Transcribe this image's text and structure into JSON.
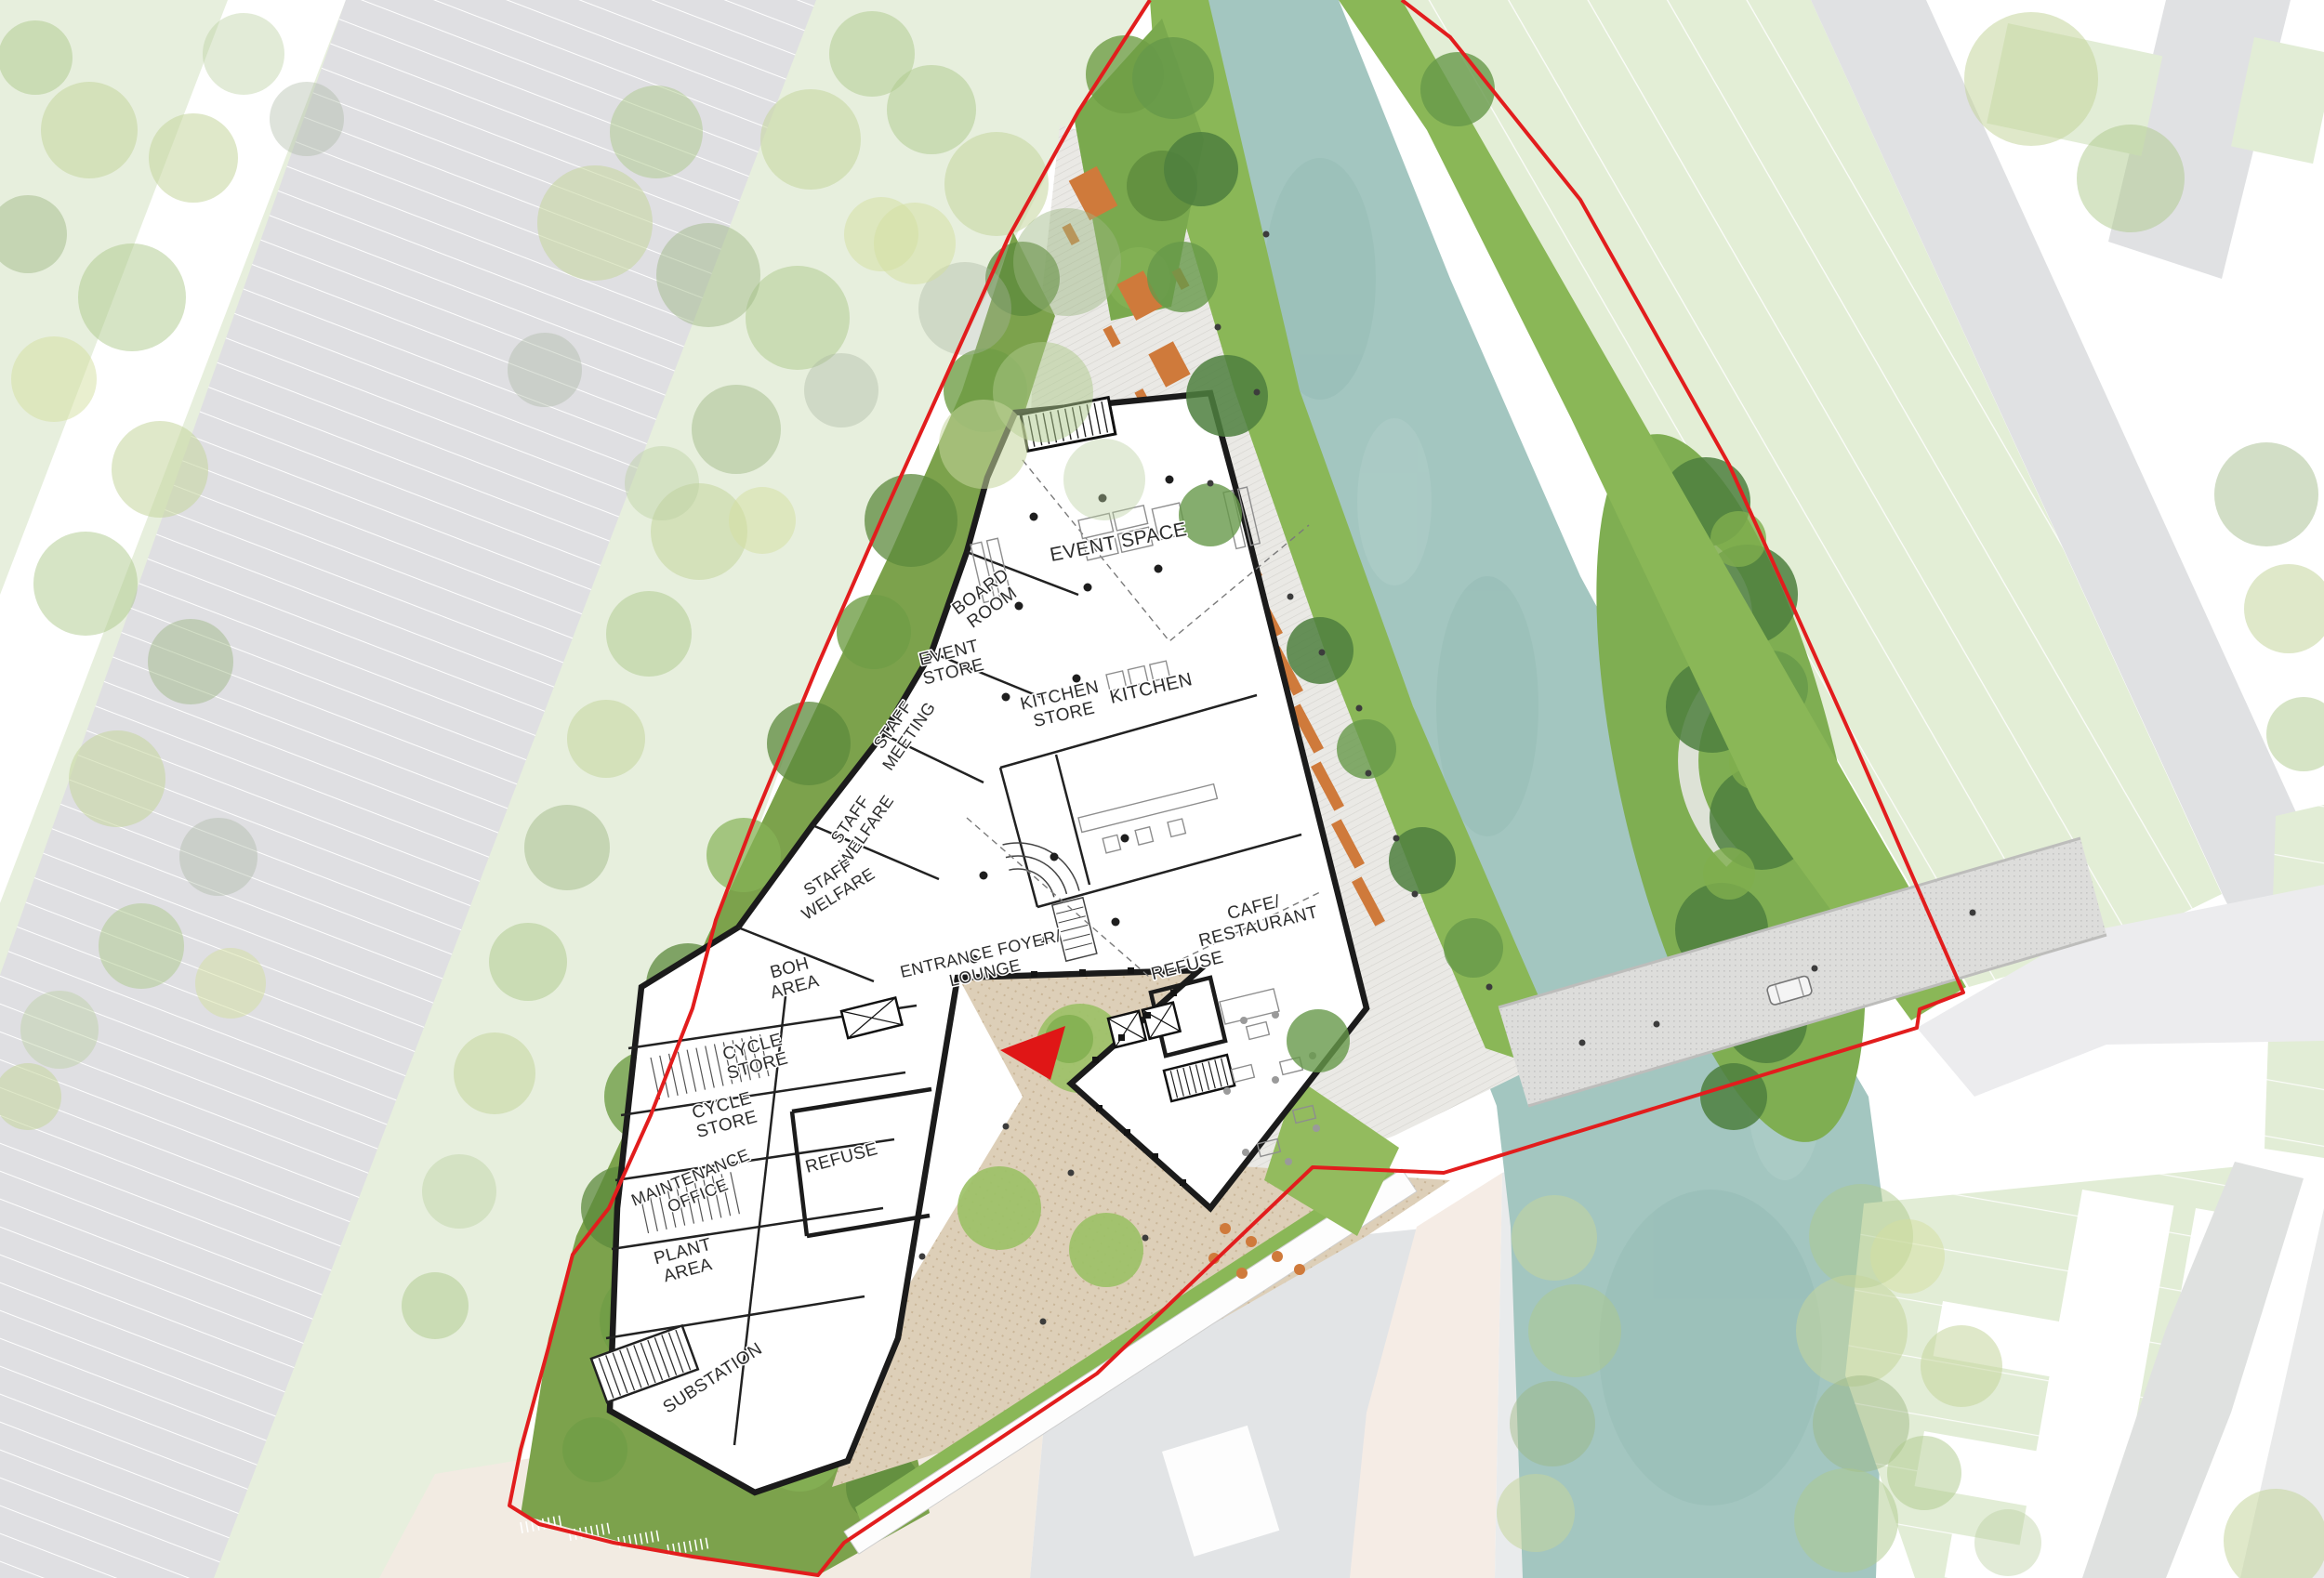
{
  "palette": {
    "site_boundary": "#e21d1d",
    "water": "#a3c6c0",
    "riverbank_green": "#8ab757",
    "island_green": "#7fae52",
    "lawn_green": "#e7efdd",
    "parking_lawn_green": "#e3eed6",
    "road_grey": "#e0e1e3",
    "promenade_grey": "#eae9e5",
    "plaza_beige": "#ddcfb8",
    "building_wall": "#1b1b1b",
    "furniture_orange": "#cf7a3b",
    "entrance_arrow": "#e01616"
  },
  "plan": {
    "rooms": {
      "event_space": {
        "label": "EVENT SPACE"
      },
      "board_room": {
        "lines": [
          "BOARD",
          "ROOM"
        ]
      },
      "event_store": {
        "lines": [
          "EVENT",
          "STORE"
        ]
      },
      "kitchen": {
        "label": "KITCHEN"
      },
      "kitchen_store": {
        "lines": [
          "KITCHEN",
          "STORE"
        ]
      },
      "staff_meeting": {
        "lines": [
          "STAFF",
          "MEETING"
        ]
      },
      "staff_welfare_upper": {
        "lines": [
          "STAFF",
          "WELFARE"
        ]
      },
      "staff_welfare_lower": {
        "lines": [
          "STAFF",
          "WELFARE"
        ]
      },
      "boh_area": {
        "lines": [
          "BOH",
          "AREA"
        ]
      },
      "cycle_store_upper": {
        "lines": [
          "CYCLE",
          "STORE"
        ]
      },
      "cycle_store_lower": {
        "lines": [
          "CYCLE",
          "STORE"
        ]
      },
      "maintenance_office": {
        "lines": [
          "MAINTENANCE",
          "OFFICE"
        ]
      },
      "refuse_west": {
        "label": "REFUSE"
      },
      "plant_area": {
        "lines": [
          "PLANT",
          "AREA"
        ]
      },
      "substation": {
        "label": "SUBSTATION"
      },
      "entrance_foyer": {
        "lines": [
          "ENTRANCE FOYER/",
          "LOUNGE"
        ]
      },
      "refuse_east": {
        "label": "REFUSE"
      },
      "cafe_restaurant": {
        "lines": [
          "CAFE/",
          "RESTAURANT"
        ]
      }
    }
  }
}
